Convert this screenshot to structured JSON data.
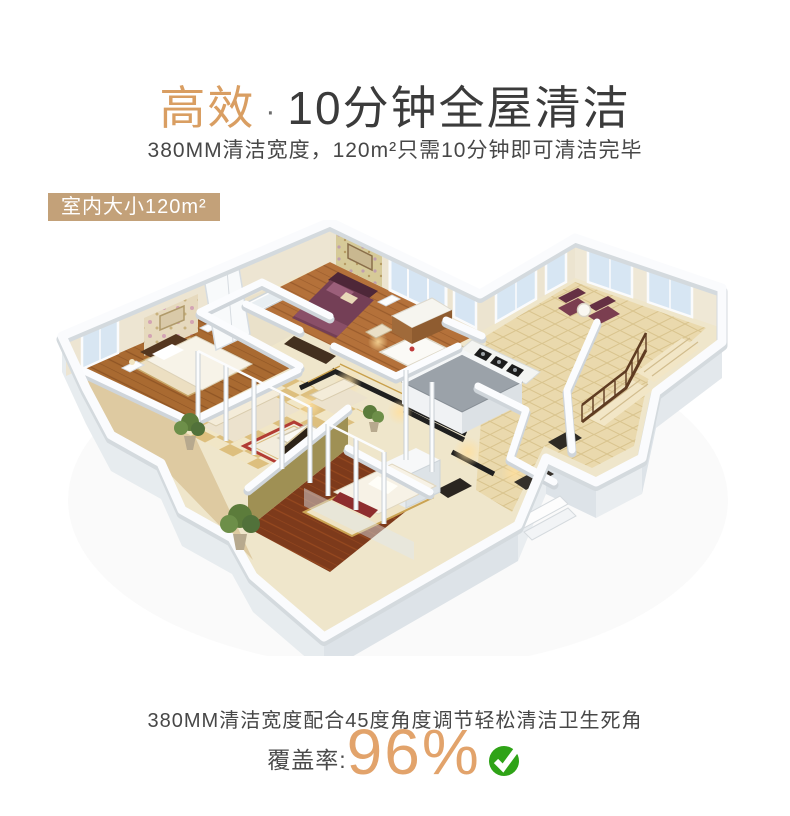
{
  "page": {
    "background": "#ffffff"
  },
  "header": {
    "title_highlight": "高效",
    "title_separator": "·",
    "title_rest": "10分钟全屋清洁",
    "subtitle": "380MM清洁宽度，120m²只需10分钟即可清洁完毕"
  },
  "floorplan": {
    "badge_label": "室内大小120m²",
    "rooms": [
      "主卧",
      "次卧",
      "客厅",
      "餐厅",
      "厨房",
      "卫生间",
      "楼梯间",
      "阳台"
    ]
  },
  "footer": {
    "caption": "380MM清洁宽度配合45度角度调节轻松清洁卫生死角",
    "coverage_label": "覆盖率:",
    "coverage_value": "96%"
  },
  "colors": {
    "accent_gold": "#d99e62",
    "coverage_gold": "#e2a36b",
    "badge_bg": "#c3a179",
    "title_dark": "#3b3b3b",
    "body_text": "#474747",
    "check_green": "#2fa317"
  },
  "icons": {
    "coverage_check": "check-circle-icon"
  }
}
